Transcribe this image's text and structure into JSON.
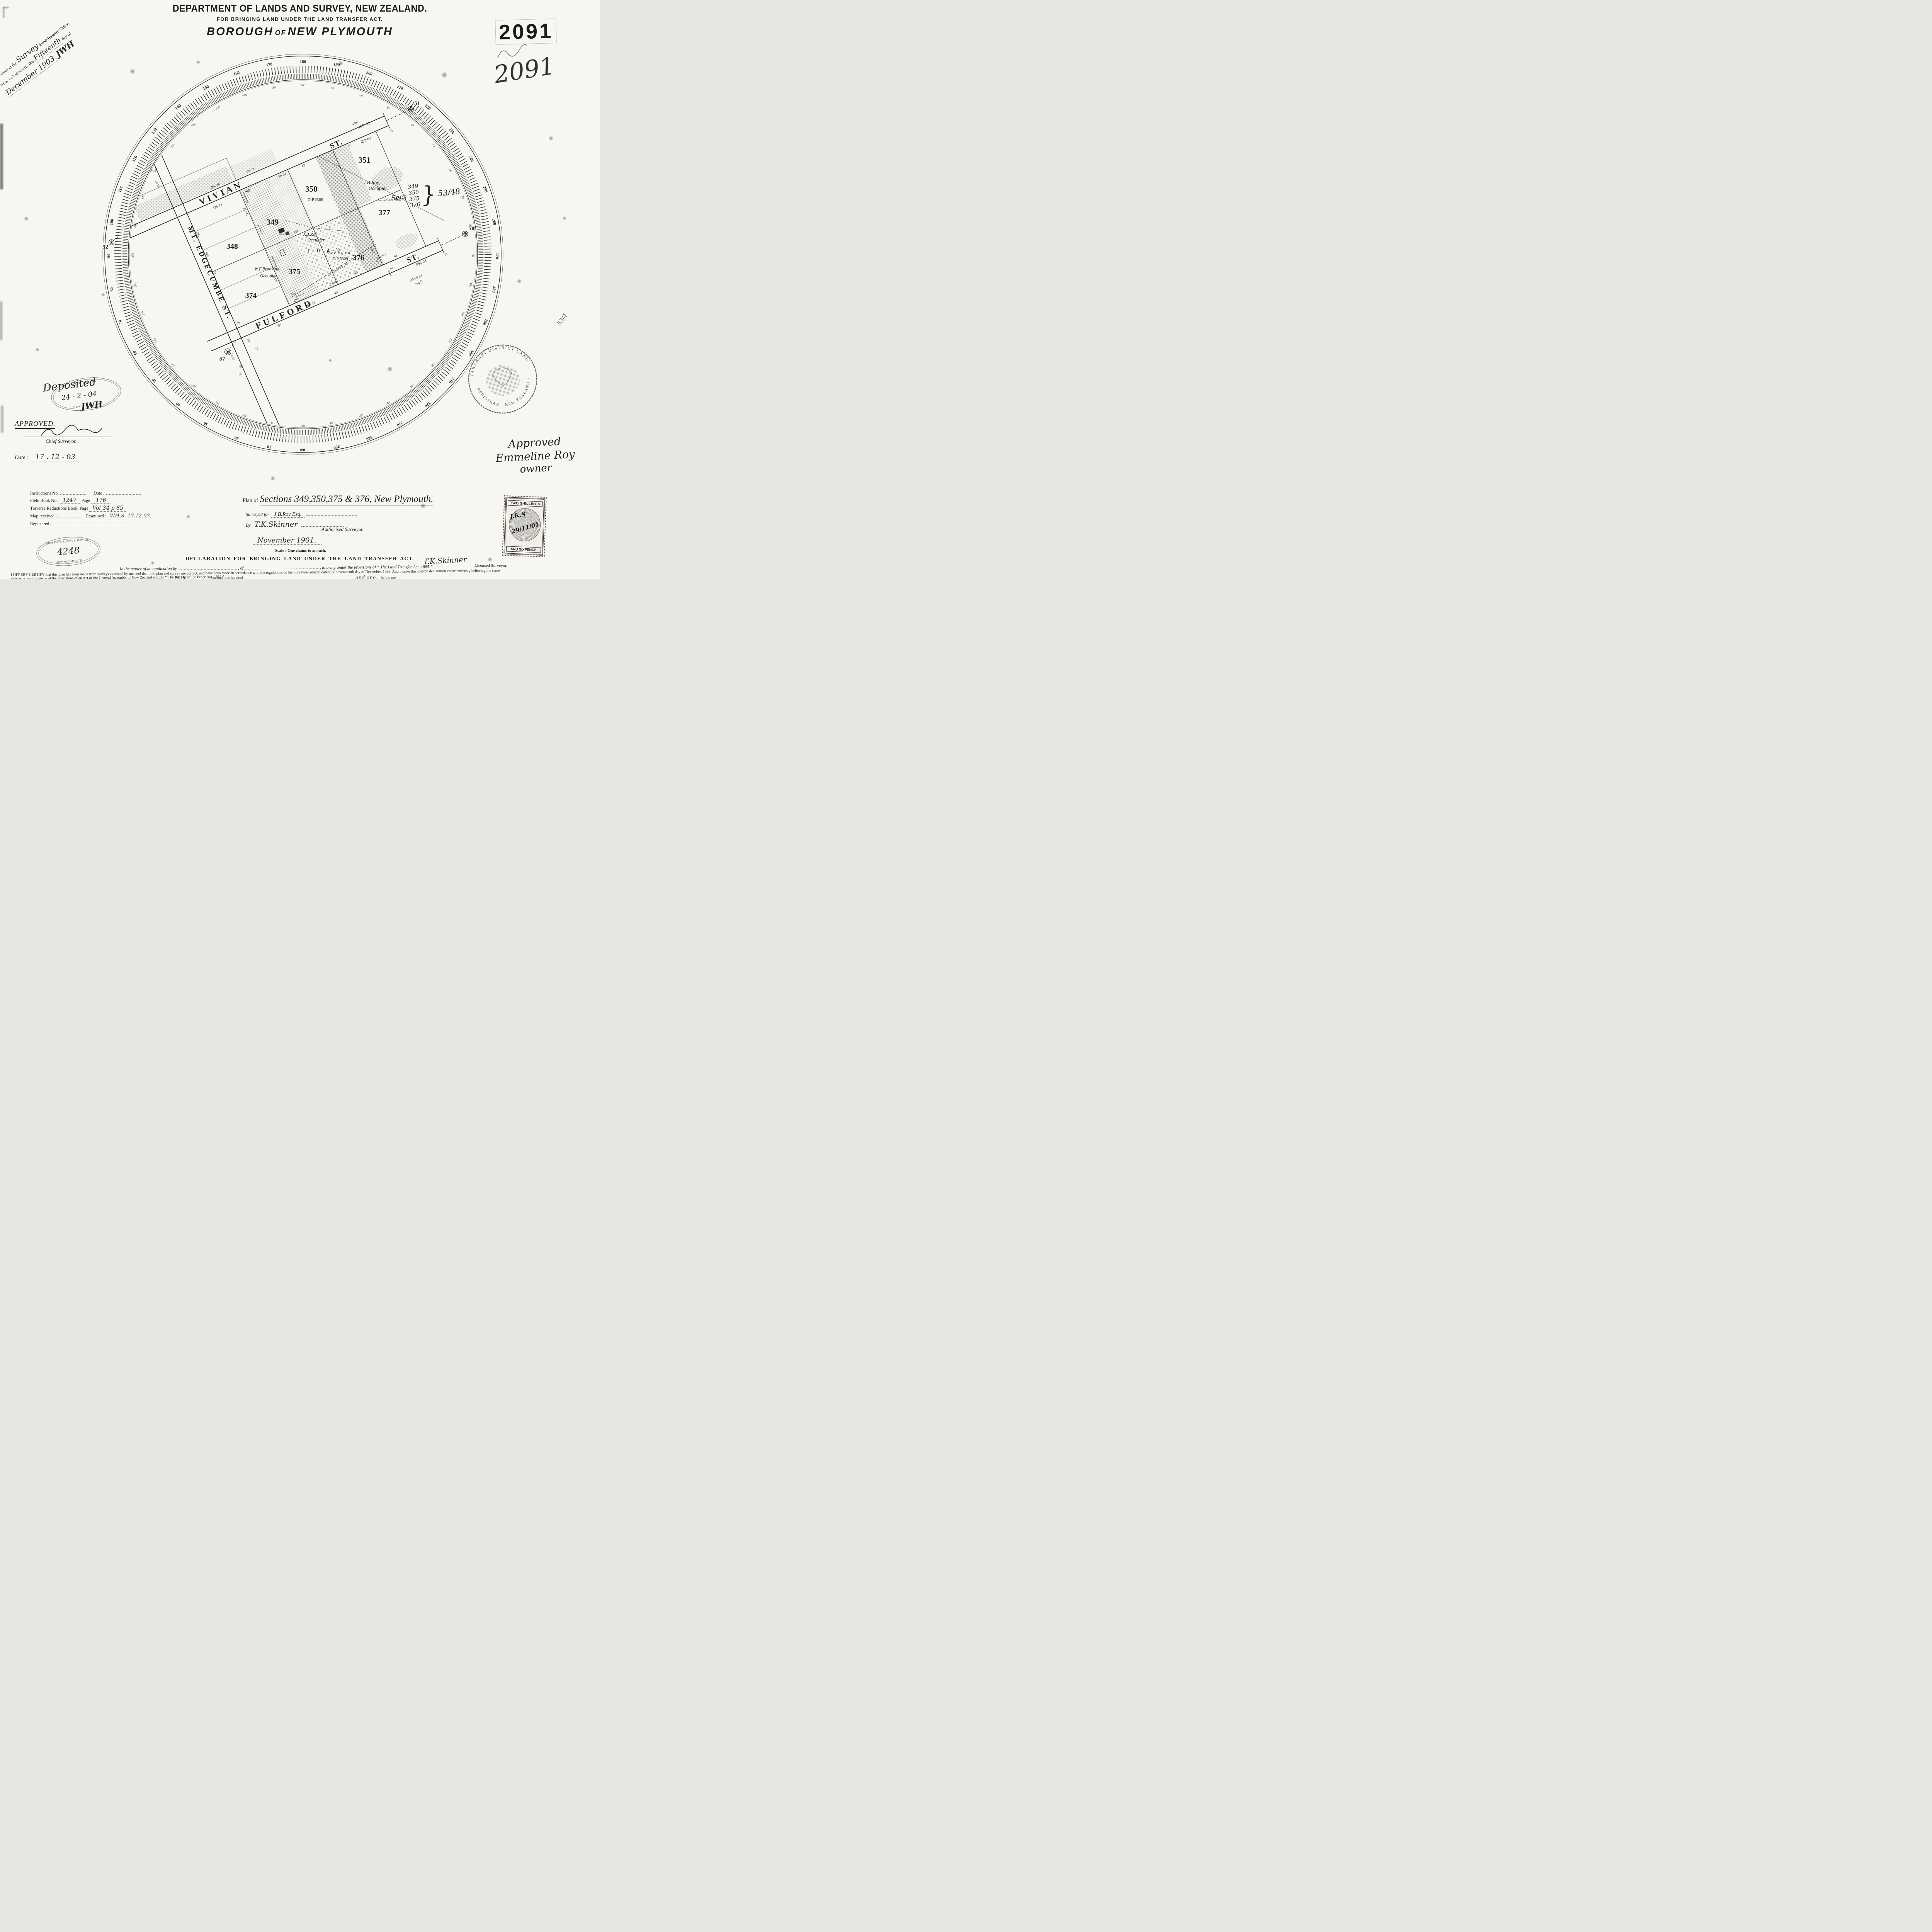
{
  "plan_number_stamp": "2091",
  "plan_number_hand": "2091",
  "header": {
    "line1": "DEPARTMENT OF LANDS AND SURVEY, NEW ZEALAND.",
    "line2": "FOR BRINGING LAND UNDER THE LAND TRANSFER ACT.",
    "title_a": "BOROUGH",
    "title_of": "OF",
    "title_b": "NEW PLYMOUTH"
  },
  "received_note": {
    "l1a": "Received at the",
    "l1_hand": "Survey",
    "l1b": "Land Transfer",
    "l1c": "Office,",
    "l2a": "NEW PLYMOUTH,",
    "l2b": "this",
    "l2_hand": "Fifteenth",
    "l2c": "day of",
    "l3_hand": "December 1903.",
    "l3_init": "JWH"
  },
  "secs_note": {
    "label": "Secs",
    "s1": "349",
    "s2": "350",
    "s3": "375",
    "s4": "376",
    "brace": "}",
    "file": "53/48"
  },
  "edge_note": "53/4",
  "map": {
    "t": {
      "vivian": "VIVIAN",
      "vivian_st": "ST.",
      "fulford": "FULFORD",
      "fulford_st": "ST.",
      "edgecumbe": "MT. EDGECUMBE ST.",
      "s348": "348",
      "s349": "349",
      "s350": "350",
      "s351": "351",
      "s374": "374",
      "s375": "375",
      "s376": "376",
      "s377": "377",
      "dp1": "D.P.6309",
      "dp2": "D.P.6309",
      "jbroy1a": "J.B.Roy,",
      "jbroy1b": "Occupier.",
      "jbroy2a": "J.B.Roy",
      "jbroy2b": "Occupier.",
      "brook_a": "W.F.Brooking.",
      "brook_b": "Occupier.",
      "residence": "Residence",
      "orchard": "Orchard",
      "ltplan": "L.T.Plan 463.",
      "area": "1 0 4·2",
      "m51": "51",
      "m52": "52",
      "m57": "57",
      "m58": "58",
      "mv1": "398·16",
      "mv2": "124·72",
      "mv3": "126·72",
      "mv4": "68°",
      "mv5": "250·44",
      "mv6": "43'",
      "mv7": "total",
      "mv8": "(1546·63)",
      "mv9": "898·03",
      "mv10": "65",
      "mv11": "25",
      "mv12": "125·72",
      "mv13": "125·72",
      "mv14": "Picket fence",
      "mv15": "Unfenced",
      "mv16": "board fence",
      "mf1": "398·16",
      "mf2": "43'",
      "mf3": "68°",
      "mf4": "250·44",
      "mf5": "43'",
      "mf6": "68°",
      "mf7": "898·03",
      "mf8": "(154·6·63",
      "mf9": "total)",
      "mf10": "65",
      "mf11": "25",
      "mf12": "20",
      "mf13": "65",
      "mf14": "25",
      "mf15": "Corrugated iron fence",
      "mf16": "fence 61·5",
      "mf17": "fence 64",
      "mf18": "Totara",
      "mt1": "338°",
      "mt2": "43'",
      "miv": "IV",
      "me1": "51·71",
      "me2": "20",
      "me3": "158°",
      "me4": "540",
      "me5": "43'",
      "me6": "51·71",
      "me7": "20",
      "mc1": "68°",
      "mg1": "Gate",
      "mg2": "Gate"
    }
  },
  "protractor": {
    "outer": [
      "180",
      "190",
      "200",
      "210",
      "220",
      "230",
      "240",
      "250",
      "260",
      "270",
      "280",
      "290",
      "300",
      "310",
      "320",
      "330",
      "340",
      "350",
      "360",
      "10",
      "20",
      "30",
      "40",
      "50",
      "60",
      "70",
      "80",
      "90",
      "100",
      "110",
      "120",
      "130",
      "140",
      "150",
      "160",
      "170"
    ],
    "inner": [
      "360",
      "10",
      "20",
      "30",
      "40",
      "50",
      "60",
      "70",
      "80",
      "90",
      "100",
      "110",
      "120",
      "130",
      "140",
      "150",
      "160",
      "170",
      "180",
      "190",
      "200",
      "210",
      "220",
      "230",
      "240",
      "250",
      "260",
      "270",
      "280",
      "290",
      "300",
      "310",
      "320",
      "330",
      "340",
      "350"
    ]
  },
  "deposited_stamp": {
    "arc_top": "DIST. SURVEY",
    "arc_bottom": "NEW PLYMOUTH",
    "hand_word": "Deposited",
    "hand_date": "24 - 2 - 04",
    "hand_init": "JWH"
  },
  "approval": {
    "approved": "APPROVED.",
    "chief": "Chief Surveyor.",
    "date_label": "Date :",
    "date_value": "17 . 12 - 03"
  },
  "registrar_stamp": {
    "text_top": "TARANAKI DISTRICT LAND",
    "text_bottom": "REGISTRAR · NEW ZEALAND ·"
  },
  "owner_note": {
    "l1": "Approved",
    "l2": "Emmeline Roy",
    "l3": "owner"
  },
  "fields": {
    "instructions_label": "Instructions No.",
    "date_label": "Date :",
    "fieldbook_label": "Field Book No.",
    "fieldbook_value": "1247",
    "page_label": "Page",
    "page_value": "176",
    "traverse_label": "Traverse Reductions Book, Page",
    "traverse_value": "Vol 34 p 85",
    "map_received_label": "Map received :",
    "examined_label": "Examined :",
    "examined_value": "WH.S.  17.12.03.",
    "registered_label": "Registered :"
  },
  "survey_office_stamp": {
    "arc_top": "DISTRICT SURVEY OFFICE",
    "number": "4248",
    "arc_bottom": "NEW PLYMOUTH"
  },
  "title_block": {
    "plan_of": "Plan of",
    "title": "Sections 349,350,375 & 376, New Plymouth.",
    "surveyed_for_label": "Surveyed for",
    "surveyed_for_value": "J.B.Roy Esq.",
    "by_label": "By",
    "by_signature": "T.K.Skinner",
    "authorised": "Authorised  Surveyor.",
    "date": "November  1901.",
    "scale": "Scale : One chains to an inch."
  },
  "revenue_stamp": {
    "top": "TWO  SHILLINGS",
    "bottom": "AND SIXPENCE",
    "hand1": "J.K.S",
    "hand2": "29/11/01"
  },
  "declaration": {
    "heading": "DECLARATION  FOR  BRINGING  LAND  UNDER  THE  LAND  TRANSFER  ACT.",
    "inmatter_a": "In the matter of an application by",
    "inmatter_b": ", of",
    "inmatter_c": ", to bring under the provisions of “ The Land Transfer Act, 1885.”",
    "para_line1": "I HEREBY CERTIFY that this plan has been made from surveys executed by me, and that both plan and survey are correct, and have been made in accordance with the regulations of the Surveyor-General dated the seventeenth day of December, 1896:  And I make this solemn declaration conscientiously believing the same",
    "para_line2": "to be true, and by virtue of the provisions of an Act of the General Assembly of New Zealand entitled “ The Justices of the Peace Act, 1882.”",
    "signature": "T.K.Skinner",
    "licensed": "Licensed Surveyor.",
    "frag_1": "20th",
    "frag_2": "thousand nine hundred",
    "frag_3": "and one,",
    "frag_4": "before me"
  }
}
